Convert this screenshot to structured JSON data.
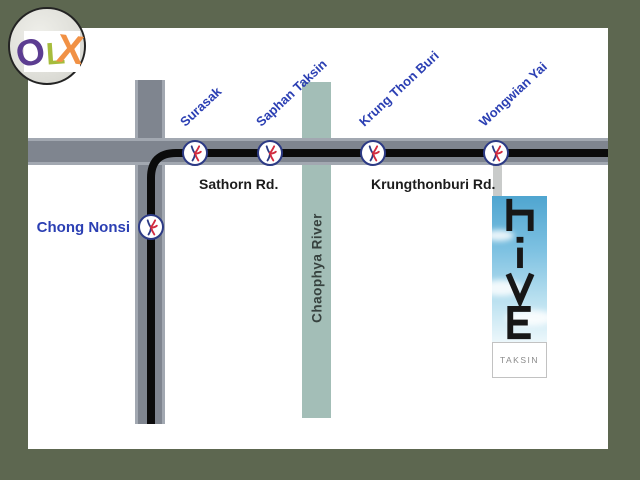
{
  "logo": {
    "letters": [
      {
        "char": "O",
        "color": "#5c3d91"
      },
      {
        "char": "L",
        "color": "#a6bc3c"
      },
      {
        "char": "X",
        "color": "#f19145"
      }
    ]
  },
  "map": {
    "stations": [
      {
        "name": "Surasak"
      },
      {
        "name": "Saphan Taksin"
      },
      {
        "name": "Krung Thon Buri"
      },
      {
        "name": "Wongwian Yai"
      },
      {
        "name": "Chong Nonsi"
      }
    ],
    "roads": {
      "sathorn": "Sathorn Rd.",
      "krungthonburi": "Krungthonburi Rd."
    },
    "river": "Chaophya River",
    "building": {
      "name": "hive",
      "sublabel": "TAKSIN"
    }
  },
  "colors": {
    "frame_olive": "#5d6750",
    "road_gray": "#7f858f",
    "river_teal": "#a3beb7",
    "rail_black": "#0b0b0b",
    "station_label_blue": "#2b3fb3",
    "station_ring_navy": "#2c3a85",
    "station_logo_red": "#d22b3f",
    "banner_sky_blue": "#4fa5d0"
  }
}
